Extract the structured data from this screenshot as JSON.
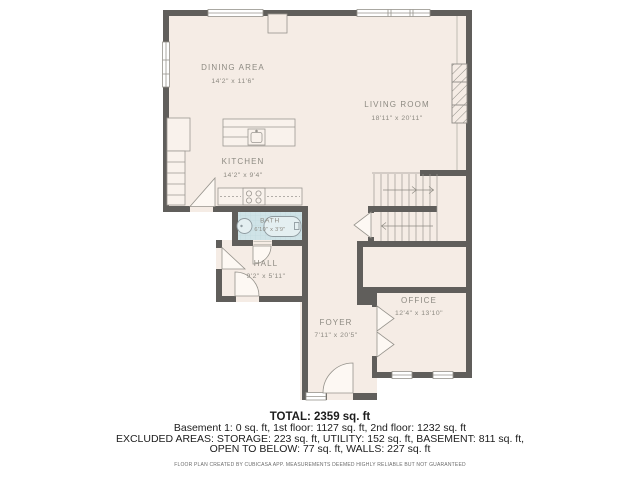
{
  "rooms": {
    "dining": {
      "name": "DINING AREA",
      "dims": "14'2\" x 11'6\""
    },
    "living": {
      "name": "LIVING ROOM",
      "dims": "18'11\" x 20'11\""
    },
    "kitchen": {
      "name": "KITCHEN",
      "dims": "14'2\" x 9'4\""
    },
    "bath": {
      "name": "BATH",
      "dims": "6'10\" x 3'9\""
    },
    "hall": {
      "name": "HALL",
      "dims": "9'2\" x 5'11\""
    },
    "foyer": {
      "name": "FOYER",
      "dims": "7'11\" x 20'5\""
    },
    "office": {
      "name": "OFFICE",
      "dims": "12'4\" x 13'10\""
    }
  },
  "summary": {
    "total": "TOTAL: 2359 sq. ft",
    "floors": "Basement 1: 0 sq. ft, 1st floor: 1127 sq. ft, 2nd floor: 1232 sq. ft",
    "excluded_line1": "EXCLUDED AREAS: STORAGE: 223 sq. ft, UTILITY: 152 sq. ft, BASEMENT: 811 sq. ft,",
    "excluded_line2": "OPEN TO BELOW: 77 sq. ft, WALLS: 227 sq. ft",
    "disclaimer": "FLOOR PLAN CREATED BY CUBICASA APP. MEASUREMENTS DEEMED HIGHLY RELIABLE BUT NOT GUARANTEED"
  },
  "colors": {
    "wall": "#605e5b",
    "floor": "#f5ece5",
    "bath_floor": "#cfe3e7",
    "outline": "#9b9791",
    "label": "#8d8a82"
  }
}
